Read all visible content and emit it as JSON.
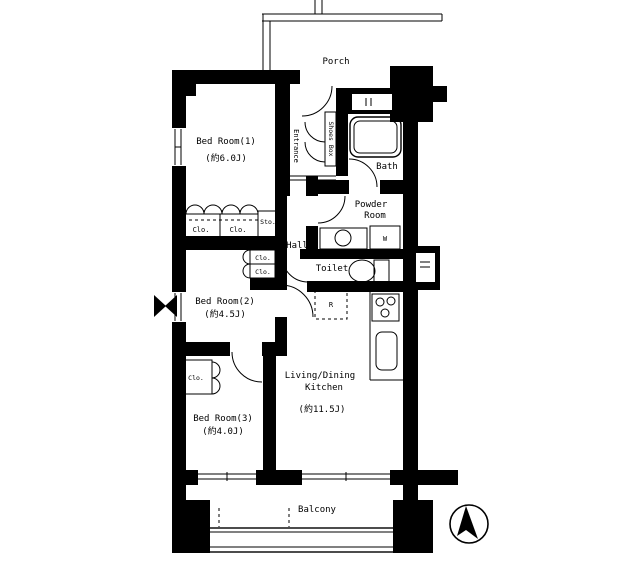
{
  "floorplan": {
    "rooms": {
      "porch": {
        "label": "Porch"
      },
      "entrance": {
        "label": "Entrance"
      },
      "bath": {
        "label": "Bath"
      },
      "powder_room": {
        "label_line1": "Powder",
        "label_line2": "Room"
      },
      "toilet": {
        "label": "Toilet"
      },
      "hall": {
        "label": "Hall"
      },
      "bedroom1": {
        "label": "Bed Room(1)",
        "size": "(約6.0J)"
      },
      "bedroom2": {
        "label": "Bed Room(2)",
        "size": "(約4.5J)"
      },
      "bedroom3": {
        "label": "Bed Room(3)",
        "size": "(約4.0J)"
      },
      "ldk": {
        "label_line1": "Living/Dining",
        "label_line2": "Kitchen",
        "size": "(約11.5J)"
      },
      "balcony": {
        "label": "Balcony"
      }
    },
    "storage": {
      "closet_label": "Clo.",
      "storage_label": "Sto.",
      "shoes_box_label": "Shoes Box"
    },
    "fixtures": {
      "washing_machine": "W",
      "refrigerator": "R"
    },
    "colors": {
      "wall": "#000000",
      "background": "#ffffff"
    }
  }
}
